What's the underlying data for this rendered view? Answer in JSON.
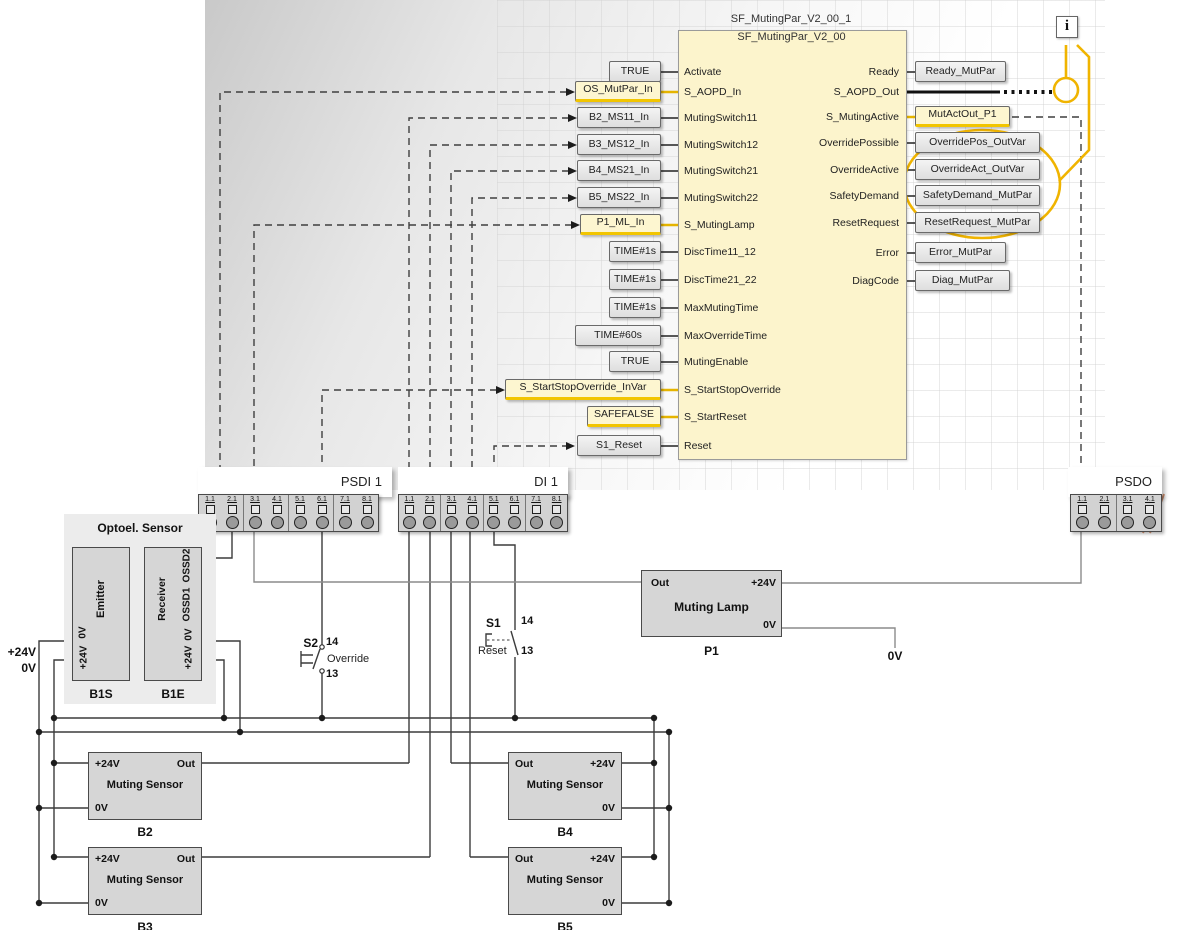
{
  "title": {
    "instance": "SF_MutingPar_V2_00_1",
    "type": "SF_MutingPar_V2_00"
  },
  "info_icon": {
    "glyph": "i"
  },
  "colors": {
    "accent_gold": "#F0B400",
    "highlight_yellow": "#F2C500",
    "block_fill": "#FCF4CC",
    "box_gray": "#E9E9E9",
    "lamp_yellow": "#F6E050",
    "wire_dark": "#3C3C3C",
    "wire_gray": "#8C8C8C"
  },
  "fb": {
    "inputs": [
      {
        "pin": "Activate",
        "var": "TRUE"
      },
      {
        "pin": "S_AOPD_In",
        "var": "OS_MutPar_In"
      },
      {
        "pin": "MutingSwitch11",
        "var": "B2_MS11_In"
      },
      {
        "pin": "MutingSwitch12",
        "var": "B3_MS12_In"
      },
      {
        "pin": "MutingSwitch21",
        "var": "B4_MS21_In"
      },
      {
        "pin": "MutingSwitch22",
        "var": "B5_MS22_In"
      },
      {
        "pin": "S_MutingLamp",
        "var": "P1_ML_In"
      },
      {
        "pin": "DiscTime11_12",
        "var": "TIME#1s"
      },
      {
        "pin": "DiscTime21_22",
        "var": "TIME#1s"
      },
      {
        "pin": "MaxMutingTime",
        "var": "TIME#1s"
      },
      {
        "pin": "MaxOverrideTime",
        "var": "TIME#60s"
      },
      {
        "pin": "MutingEnable",
        "var": "TRUE"
      },
      {
        "pin": "S_StartStopOverride",
        "var": "S_StartStopOverride_InVar"
      },
      {
        "pin": "S_StartReset",
        "var": "SAFEFALSE"
      },
      {
        "pin": "Reset",
        "var": "S1_Reset"
      }
    ],
    "outputs": [
      {
        "pin": "Ready",
        "var": "Ready_MutPar"
      },
      {
        "pin": "S_AOPD_Out",
        "var": ""
      },
      {
        "pin": "S_MutingActive",
        "var": "MutActOut_P1"
      },
      {
        "pin": "OverridePossible",
        "var": "OverridePos_OutVar"
      },
      {
        "pin": "OverrideActive",
        "var": "OverrideAct_OutVar"
      },
      {
        "pin": "SafetyDemand",
        "var": "SafetyDemand_MutPar"
      },
      {
        "pin": "ResetRequest",
        "var": "ResetRequest_MutPar"
      },
      {
        "pin": "Error",
        "var": "Error_MutPar"
      },
      {
        "pin": "DiagCode",
        "var": "Diag_MutPar"
      }
    ]
  },
  "terminals": {
    "psdi": {
      "label": "PSDI 1",
      "points": [
        "1.1",
        "2.1",
        "3.1",
        "4.1",
        "5.1",
        "6.1",
        "7.1",
        "8.1"
      ]
    },
    "di": {
      "label": "DI 1",
      "points": [
        "1.1",
        "2.1",
        "3.1",
        "4.1",
        "5.1",
        "6.1",
        "7.1",
        "8.1"
      ]
    },
    "psdo": {
      "label": "PSDO",
      "points": [
        "1.1",
        "2.1",
        "3.1",
        "4.1"
      ]
    }
  },
  "optoel": {
    "title": "Optoel. Sensor",
    "emitter": "Emitter",
    "receiver": "Receiver",
    "emitter_ref": "B1S",
    "receiver_ref": "B1E",
    "emitter_pins": [
      "0V",
      "+24V"
    ],
    "receiver_pins": [
      "OSSD2",
      "OSSD1",
      "0V",
      "+24V"
    ]
  },
  "supply": {
    "p24": "+24V",
    "zero": "0V"
  },
  "lamp": {
    "out": "Out",
    "p24": "+24V",
    "title": "Muting Lamp",
    "zero": "0V",
    "ref": "P1"
  },
  "zero_drop": "0V",
  "switches": {
    "s2": {
      "ref": "S2",
      "no": "14",
      "nc": "13",
      "label": "Override"
    },
    "s1": {
      "ref": "S1",
      "no": "14",
      "nc": "13",
      "label": "Reset"
    }
  },
  "sensors": {
    "title": "Muting Sensor",
    "p24": "+24V",
    "out": "Out",
    "zero": "0V",
    "items": [
      {
        "ref": "B2"
      },
      {
        "ref": "B3"
      },
      {
        "ref": "B4"
      },
      {
        "ref": "B5"
      }
    ]
  }
}
